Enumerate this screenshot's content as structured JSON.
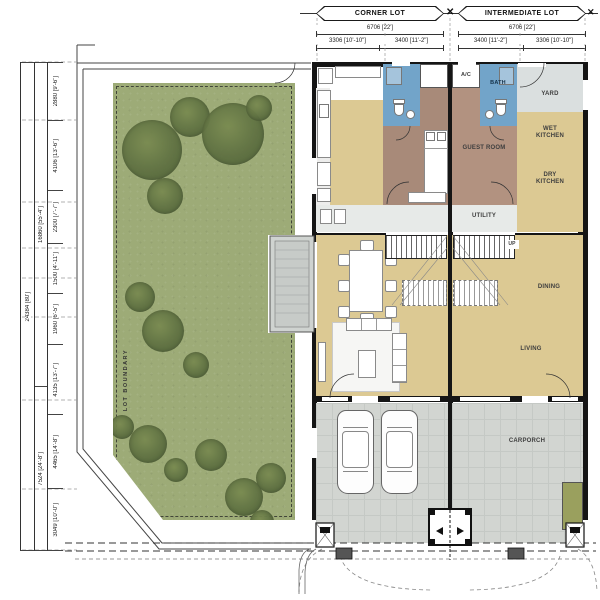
{
  "header": {
    "lots": [
      {
        "name": "CORNER LOT",
        "total": "6706 [22']",
        "segments": [
          "3306 [10'-10\"]",
          "3400 [11'-2\"]"
        ]
      },
      {
        "name": "INTERMEDIATE LOT",
        "total": "6706 [22']",
        "segments": [
          "3400 [11'-2\"]",
          "3306 [10'-10\"]"
        ]
      }
    ]
  },
  "left_dimensions": {
    "overall": [
      {
        "mm": 24384,
        "label": "24384 [80']"
      }
    ],
    "groups": [
      {
        "mm": 16860,
        "label": "16860 [55'-4\"]"
      },
      {
        "mm": 7524,
        "label": "7524 [24'-8\"]"
      }
    ],
    "segments": [
      {
        "mm": 2880,
        "label": "2880 [9'-6\"]"
      },
      {
        "mm": 4106,
        "label": "4106 [13'-6\"]"
      },
      {
        "mm": 2300,
        "label": "2300 [7'-7\"]"
      },
      {
        "mm": 1500,
        "label": "1500 [4'-11\"]"
      },
      {
        "mm": 1960,
        "label": "1960 [6'-5\"]"
      },
      {
        "mm": 4135,
        "label": "4135 [13'-7\"]"
      },
      {
        "mm": 4465,
        "label": "4465 [14'-8\"]"
      },
      {
        "mm": 3049,
        "label": "3049 [10'-0\"]"
      }
    ]
  },
  "site": {
    "boundary_label": "LOT BOUNDARY"
  },
  "rooms": {
    "ac": "A/C",
    "bath": "BATH",
    "yard": "YARD",
    "wet_kitchen": "WET KITCHEN",
    "dry_kitchen": "DRY KITCHEN",
    "guest_room": "GUEST ROOM",
    "utility": "UTILITY",
    "dining": "DINING",
    "living": "LIVING",
    "carporch": "CARPORCH",
    "up": "UP"
  },
  "garden": {
    "trees": [
      {
        "x": 39,
        "y": 67,
        "r": 30
      },
      {
        "x": 77,
        "y": 34,
        "r": 20
      },
      {
        "x": 120,
        "y": 51,
        "r": 31
      },
      {
        "x": 52,
        "y": 113,
        "r": 18
      },
      {
        "x": 146,
        "y": 25,
        "r": 13
      },
      {
        "x": 27,
        "y": 214,
        "r": 15
      },
      {
        "x": 50,
        "y": 248,
        "r": 21
      },
      {
        "x": 83,
        "y": 282,
        "r": 13
      },
      {
        "x": 9,
        "y": 344,
        "r": 12
      },
      {
        "x": 35,
        "y": 361,
        "r": 19
      },
      {
        "x": 63,
        "y": 387,
        "r": 12
      },
      {
        "x": 98,
        "y": 372,
        "r": 16
      },
      {
        "x": 131,
        "y": 414,
        "r": 19
      },
      {
        "x": 158,
        "y": 395,
        "r": 15
      },
      {
        "x": 149,
        "y": 439,
        "r": 12
      }
    ]
  },
  "colors": {
    "wall": "#151515",
    "grass": "#9dab77",
    "tree_dark": "#5d6f41",
    "floor_tan": "#dcc993",
    "floor_brown": "#a88a79",
    "bath_blue": "#72a4c9",
    "carport": "#d2d5d1",
    "yard": "#dadfdf",
    "utility": "#e7eae8",
    "planter": "#9aa05e",
    "dim_text": "#222222"
  }
}
